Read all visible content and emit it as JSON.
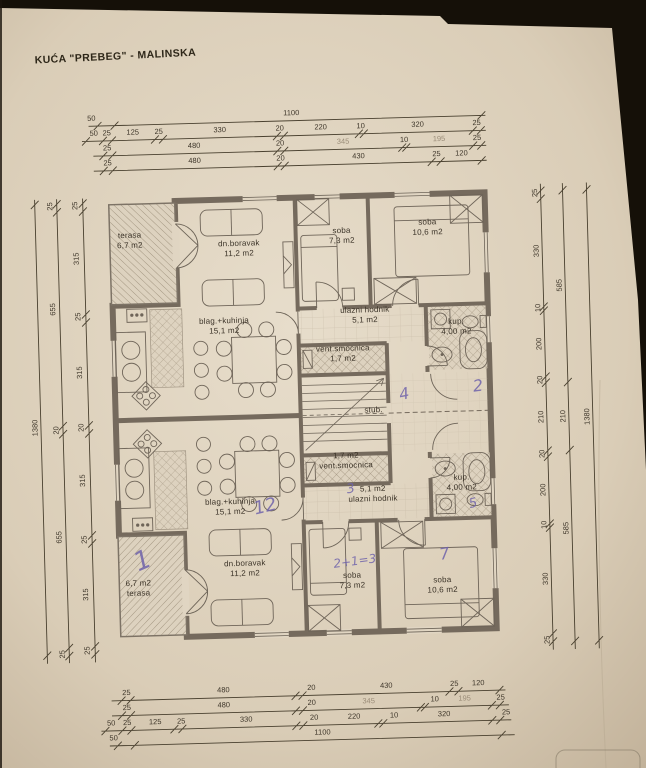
{
  "title": "KUĆA \"PREBEG\" - MALINSKA",
  "rooms": {
    "top": {
      "terasa": {
        "name": "terasa",
        "area": "6,7 m2"
      },
      "dn_boravak": {
        "name": "dn.boravak",
        "area": "11,2 m2"
      },
      "blag_kuhinja": {
        "name": "blag.+kuhinja",
        "area": "15,1 m2"
      },
      "soba_mala": {
        "name": "soba",
        "area": "7,3 m2"
      },
      "soba_velika": {
        "name": "soba",
        "area": "10,6 m2"
      },
      "ulazni_hodnik": {
        "name": "ulazni hodnik",
        "area": "5,1 m2"
      },
      "kupaonica": {
        "name": "kup.",
        "area": "4,00 m2"
      },
      "vent_smocnica": {
        "name": "vent.smocnica",
        "area": "1,7 m2"
      }
    },
    "bottom": {
      "terasa": {
        "name": "terasa",
        "area": "6,7 m2"
      },
      "dn_boravak": {
        "name": "dn.boravak",
        "area": "11,2 m2"
      },
      "blag_kuhinja": {
        "name": "blag.+kuhinja",
        "area": "15,1 m2"
      },
      "soba_mala": {
        "name": "soba",
        "area": "7,3 m2"
      },
      "soba_velika": {
        "name": "soba",
        "area": "10,6 m2"
      },
      "ulazni_hodnik": {
        "name": "ulazni hodnik",
        "area": "5,1 m2"
      },
      "kupaonica": {
        "name": "kup.",
        "area": "4,00 m2"
      },
      "vent_smocnica": {
        "name": "vent.smocnica",
        "area": "1,7 m2"
      }
    },
    "stub": {
      "name": "stub."
    }
  },
  "handwritten": {
    "stairs_count": "4",
    "right_room": "2",
    "hodnik": "3",
    "kup": "5",
    "kitchen": "12",
    "terasa": "1",
    "soba_mala": "2+1=3",
    "soba_velika": "7"
  },
  "dims": {
    "top": [
      [
        "50",
        "1100"
      ],
      [
        "50",
        "25",
        "125",
        "25",
        "330",
        "20",
        "220",
        "10",
        "320",
        "25"
      ],
      [
        "25",
        "480",
        "20",
        "345",
        "10",
        "195",
        "25"
      ],
      [
        "25",
        "480",
        "20",
        "430",
        "25",
        "120"
      ]
    ],
    "bottom": [
      [
        "25",
        "480",
        "20",
        "430",
        "25",
        "120"
      ],
      [
        "25",
        "480",
        "20",
        "345",
        "10",
        "195",
        "25"
      ],
      [
        "50",
        "25",
        "125",
        "25",
        "330",
        "20",
        "220",
        "10",
        "320",
        "25"
      ],
      [
        "50",
        "1100"
      ]
    ],
    "left": [
      [
        "25",
        "315",
        "25",
        "315",
        "20",
        "315",
        "25",
        "315",
        "25"
      ],
      [
        "25",
        "655",
        "20",
        "655",
        "25"
      ],
      [
        "1380"
      ]
    ],
    "right": [
      [
        "25",
        "330",
        "10",
        "200",
        "20",
        "210",
        "20",
        "200",
        "10",
        "330",
        "25"
      ],
      [
        "585",
        "210",
        "585"
      ],
      [
        "1380"
      ]
    ]
  },
  "colors": {
    "paper": "#dccfba",
    "ink": "#3f372b",
    "wall": "#756a5d",
    "handwriting": "#6f63ab"
  }
}
